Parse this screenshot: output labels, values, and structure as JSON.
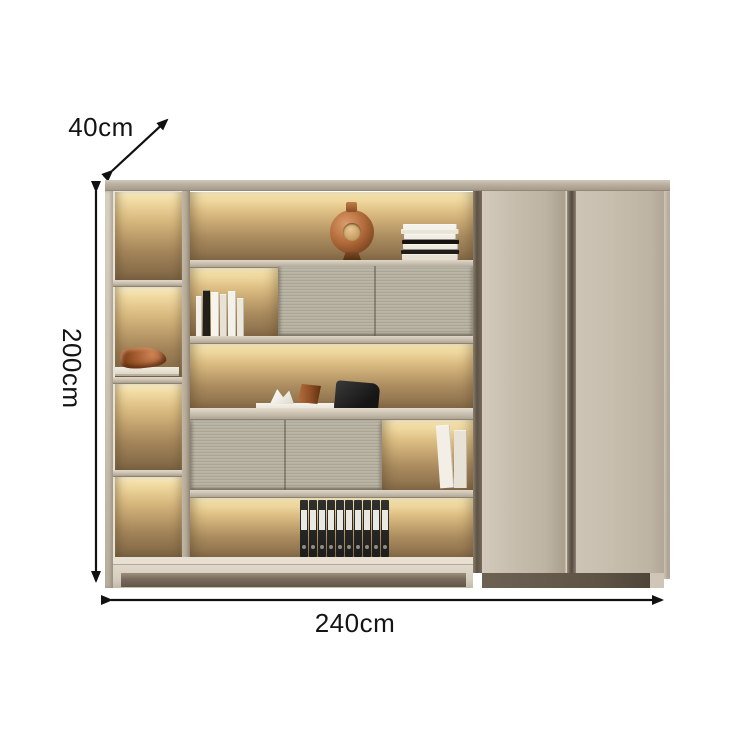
{
  "annotations": {
    "depth_label": "40cm",
    "height_label": "200cm",
    "width_label": "240cm"
  },
  "colors": {
    "background": "#ffffff",
    "annotation_text": "#141414",
    "arrow": "#111111",
    "door_face": "#c5bcab",
    "fluted_panel": "#b4af9f",
    "warm_backlight_top": "#f5e0a8",
    "warm_backlight_bottom": "#876c49",
    "frame_cream": "#e9e3d7",
    "wood_shelf": "#c9c0b0",
    "copper_ornament": "#b06a3e",
    "binder_body": "#1d1d1c",
    "binder_label": "#e9e8e3"
  },
  "decor": {
    "binders": {
      "count": 10
    },
    "standing_books": [
      {
        "w": 6,
        "h": 40,
        "c": "#f3efe6"
      },
      {
        "w": 7,
        "h": 46,
        "c": "#23201b"
      },
      {
        "w": 8,
        "h": 44,
        "c": "#f7f4ed"
      },
      {
        "w": 7,
        "h": 42,
        "c": "#e7e2d4"
      },
      {
        "w": 8,
        "h": 45,
        "c": "#f4f1e9"
      },
      {
        "w": 7,
        "h": 38,
        "c": "#ece7db"
      }
    ],
    "stacked_books": [
      {
        "w": 54,
        "h": 5,
        "c": "#f5f2ea"
      },
      {
        "w": 58,
        "h": 5,
        "c": "#eae5d9"
      },
      {
        "w": 52,
        "h": 5,
        "c": "#f2eee4"
      },
      {
        "w": 57,
        "h": 5,
        "c": "#17140f"
      },
      {
        "w": 55,
        "h": 5,
        "c": "#efeade"
      },
      {
        "w": 58,
        "h": 5,
        "c": "#211e18"
      },
      {
        "w": 56,
        "h": 6,
        "c": "#e6e1d3"
      }
    ],
    "leaning_books": [
      {
        "w": 14,
        "h": 63,
        "c": "#f3efe7",
        "tilt": -4
      },
      {
        "w": 13,
        "h": 58,
        "c": "#e7e2d5",
        "tilt": 0
      }
    ]
  }
}
